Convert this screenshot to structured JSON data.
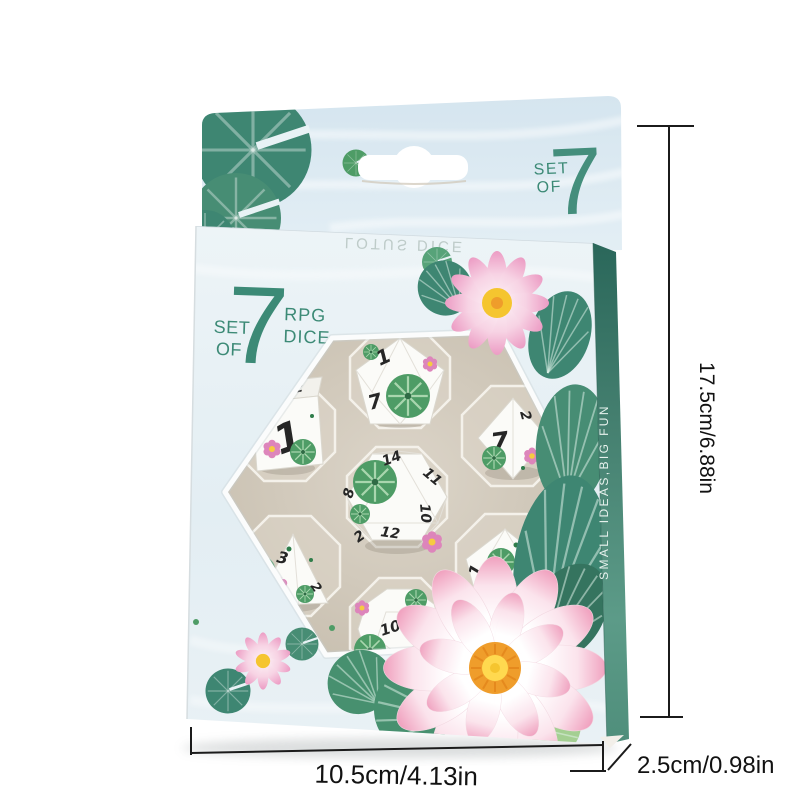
{
  "product": {
    "title": "Lotus RPG dice set in hanging retail box",
    "back_badge": {
      "set": "SET",
      "of": "OF",
      "count": "7"
    },
    "front_badge": {
      "set": "SET",
      "of": "OF",
      "count": "7",
      "rpg": "RPG",
      "dice": "DICE"
    },
    "flap_text": "LOTUS DICE",
    "spine_text": "SMALL IDEAS,BIG FUN",
    "dice": [
      {
        "type": "d6",
        "cell": "upper-left",
        "numbers": [
          "1",
          "2"
        ]
      },
      {
        "type": "d10",
        "cell": "top-center",
        "numbers": [
          "1",
          "7"
        ]
      },
      {
        "type": "d8",
        "cell": "upper-right",
        "numbers": [
          "7",
          "2"
        ]
      },
      {
        "type": "d20",
        "cell": "center",
        "numbers": [
          "14",
          "11",
          "8",
          "10",
          "12",
          "2"
        ]
      },
      {
        "type": "d4",
        "cell": "lower-left",
        "numbers": [
          "3",
          "1",
          "2"
        ]
      },
      {
        "type": "d10-percentile",
        "cell": "lower-right",
        "numbers": [
          "1",
          "3"
        ]
      },
      {
        "type": "d12",
        "cell": "bottom-center",
        "numbers": [
          "10",
          "8"
        ]
      }
    ]
  },
  "dimensions": {
    "height": "17.5cm/6.88in",
    "width": "10.5cm/4.13in",
    "depth": "2.5cm/0.98in"
  },
  "colors": {
    "accent_teal": "#3C8A76",
    "spine_teal": "#4F9383",
    "leaf_green": "#3E8672",
    "die_leaf_green": "#4E9C66",
    "flower_pink": "#F2BCD4",
    "flower_deep_pink": "#DA7FB5",
    "lotus_center_yellow": "#F5C52F",
    "lotus_center_orange": "#EF9D2B",
    "card_blue": "#DDE9F1",
    "dice_white": "#FBFBF8",
    "dimension_line": "#1B1B1B"
  }
}
